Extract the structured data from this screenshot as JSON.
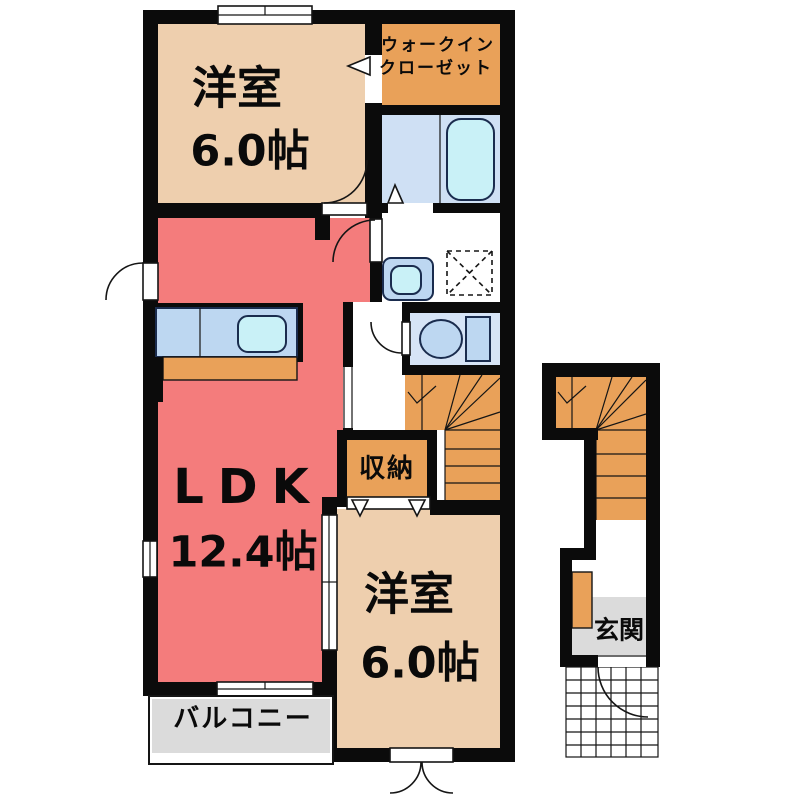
{
  "floorplan": {
    "rooms": {
      "bedroom_top": {
        "name": "洋室",
        "size": "6.0帖"
      },
      "walk_in_closet": {
        "line1": "ウォークイン",
        "line2": "クローゼット"
      },
      "ldk": {
        "name": "LDK",
        "size": "12.4帖"
      },
      "storage": {
        "label": "収納"
      },
      "bedroom_bottom": {
        "name": "洋室",
        "size": "6.0帖"
      },
      "balcony": {
        "label": "バルコニー"
      },
      "entrance": {
        "label": "玄関"
      }
    },
    "colors": {
      "wall": "#0b0b0b",
      "room_peach": "#eecfae",
      "accent_orange": "#e9a159",
      "ldk_red": "#f47c7c",
      "bath_blue": "#cfe0f4",
      "toilet_blue": "#d6e4f6",
      "fixture_blue": "#bdd7f1",
      "fixture_stroke": "#1a2c4e",
      "aqua": "#c9f1f7",
      "gray": "#dbdbdb"
    }
  }
}
